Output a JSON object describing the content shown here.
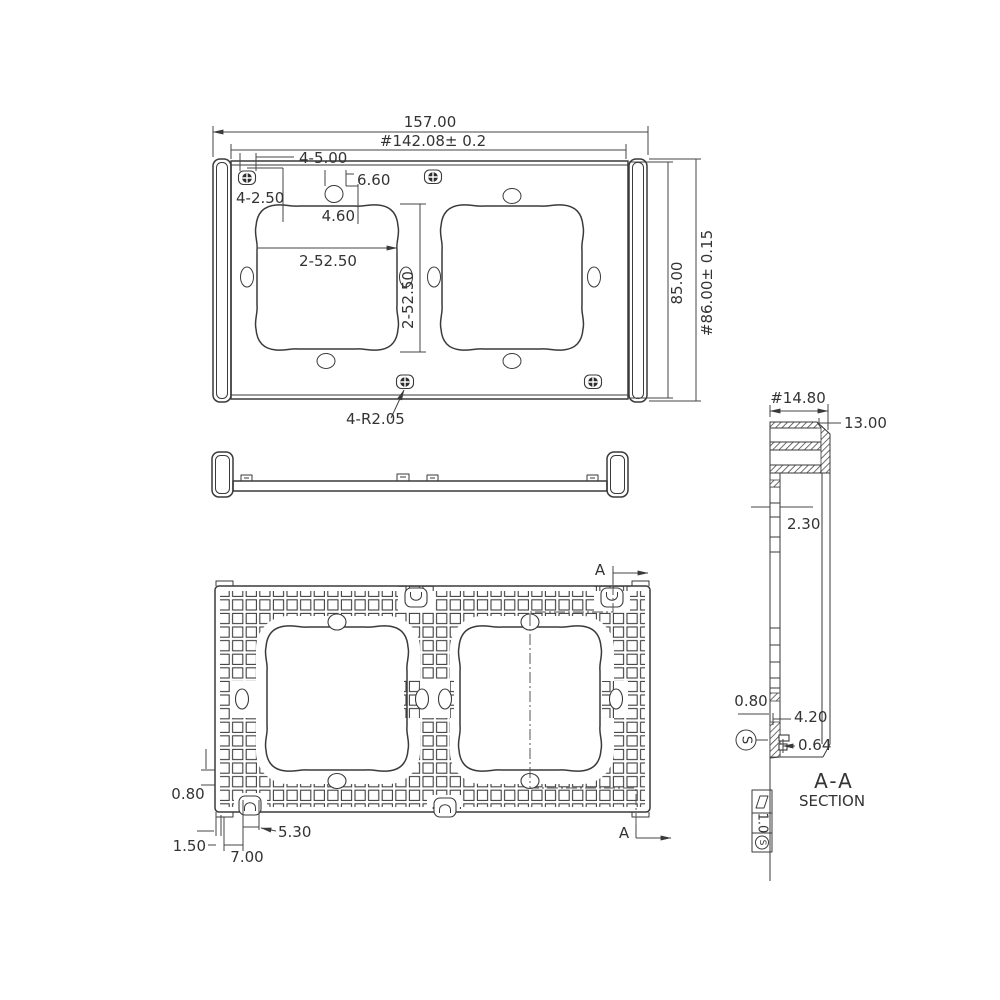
{
  "drawing": {
    "top_view": {
      "overall_width": "157.00",
      "mount_width": "#142.08± 0.2",
      "mount_holes": "4-5.00",
      "slot_width": "6.60",
      "pilot_holes": "4-2.50",
      "slot_depth": "4.60",
      "opening_width": "2-52.50",
      "opening_height": "2-52.50",
      "plate_height": "85.00",
      "overall_height": "#86.00± 0.15",
      "corner_radius": "4-R2.05"
    },
    "back_view": {
      "rib_thickness": "0.80",
      "edge_gap": "1.50",
      "tab_width": "7.00",
      "clip_width": "5.30",
      "section_marker_top": "A",
      "section_marker_bottom": "A"
    },
    "section_view": {
      "overall_depth": "#14.80",
      "inner_depth": "13.00",
      "wall_thickness": "2.30",
      "rib_width": "0.80",
      "clip_height": "4.20",
      "clip_step": "0.64",
      "datum_label": "S",
      "title": "A-A",
      "subtitle": "SECTION",
      "flatness_tolerance": "1.0",
      "flatness_datum": "S"
    }
  }
}
